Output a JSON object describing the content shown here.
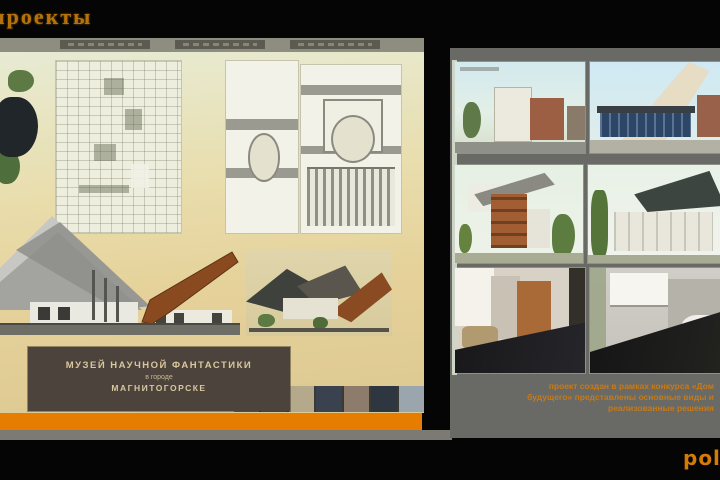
{
  "header": {
    "title": "проекты"
  },
  "sheet": {
    "title_line1": "МУЗЕЙ НАУЧНОЙ ФАНТАСТИКИ",
    "title_line2": "в городе",
    "title_line3": "МАГНИТОГОРСКЕ"
  },
  "gallery": {
    "caption_line1": "проект создан в рамках конкурса «Дом",
    "caption_line2": "будущего» представлены основные виды и",
    "caption_line3": "реализованные решения"
  },
  "footer": {
    "logo_text": "polis"
  },
  "colors": {
    "accent_orange": "#e67c00",
    "caption_orange": "#c87a16",
    "sheet_tan": "#e4d29c",
    "panel_gray": "#696965",
    "title_box_brown": "#4c443c",
    "title_text_tan": "#d9c79e"
  }
}
